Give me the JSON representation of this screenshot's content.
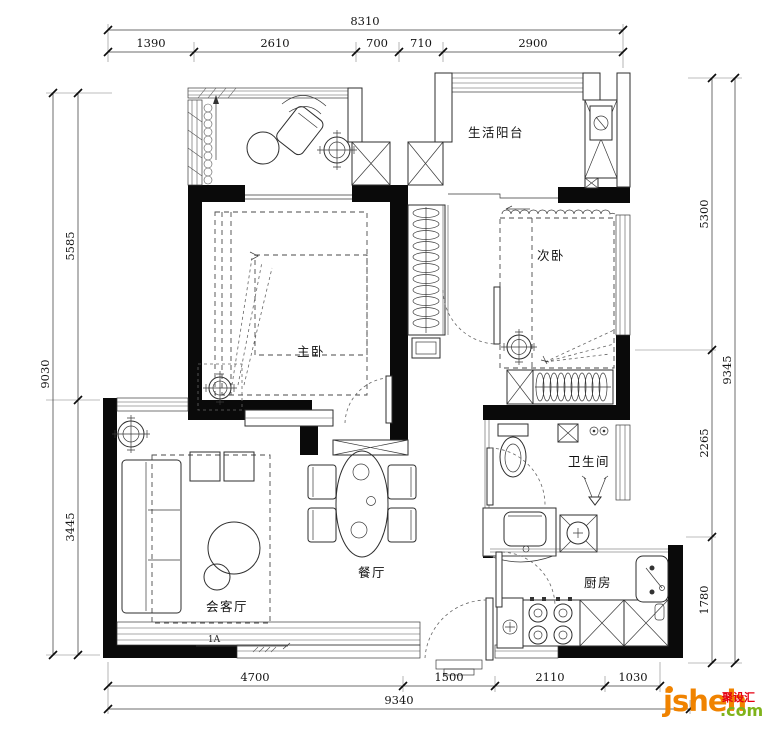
{
  "drawing": {
    "type": "apartment floor plan",
    "rooms": {
      "life_balcony": "生活阳台",
      "second_bedroom": "次卧",
      "master_bedroom": "主卧",
      "bathroom": "卫生间",
      "living_room": "会客厅",
      "dining_room": "餐厅",
      "kitchen": "厨房"
    },
    "entry_marker": "1A"
  },
  "dims": {
    "top_total": "8310",
    "top_segments": [
      "1390",
      "2610",
      "700",
      "710",
      "2900"
    ],
    "left_total": "9030",
    "left_segments": [
      "5585",
      "3445"
    ],
    "right_total": "9345",
    "right_segments": [
      "5300",
      "2265",
      "1780"
    ],
    "bottom_total": "9340",
    "bottom_segments": [
      "4700",
      "1500",
      "2110",
      "1030"
    ]
  },
  "watermark": {
    "brand": "jsheh",
    "tld": ".com",
    "cn": "聚设汇",
    "orange": "#F08300",
    "green": "#7FB31B",
    "red": "#E60012"
  }
}
